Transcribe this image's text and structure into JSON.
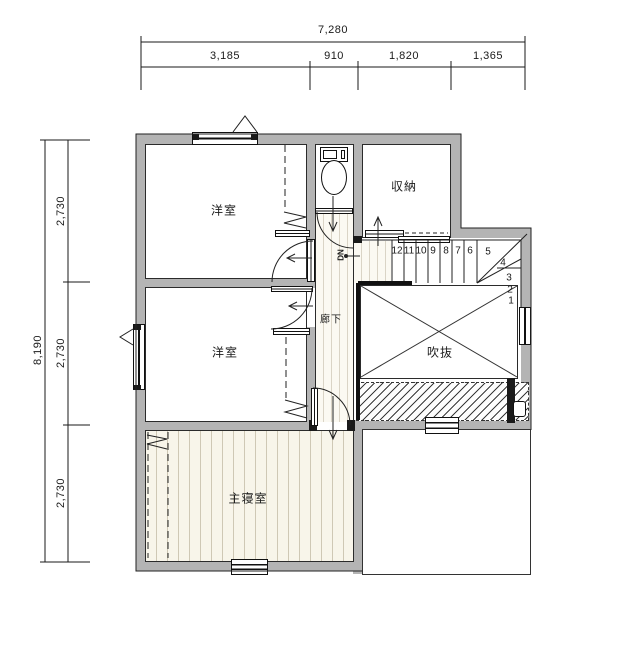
{
  "dimensions": {
    "top": {
      "total": "7,280",
      "segments": [
        "3,185",
        "910",
        "1,820",
        "1,365"
      ]
    },
    "left": {
      "total": "8,190",
      "segments": [
        "2,730",
        "2,730",
        "2,730"
      ]
    }
  },
  "rooms": {
    "western_room_1": "洋室",
    "western_room_2": "洋室",
    "master_bedroom": "主寝室",
    "storage": "収納",
    "hallway": "廊下",
    "void_atrium": "吹抜",
    "stairs_direction": "DN"
  },
  "stairs": {
    "steps": [
      "12",
      "11",
      "10",
      "9",
      "8",
      "7",
      "6",
      "5",
      "4",
      "3",
      "2",
      "1"
    ]
  },
  "colors": {
    "wall": "#b4b4b4",
    "floor": "#f8f5ea",
    "line": "#1a1a1a"
  }
}
